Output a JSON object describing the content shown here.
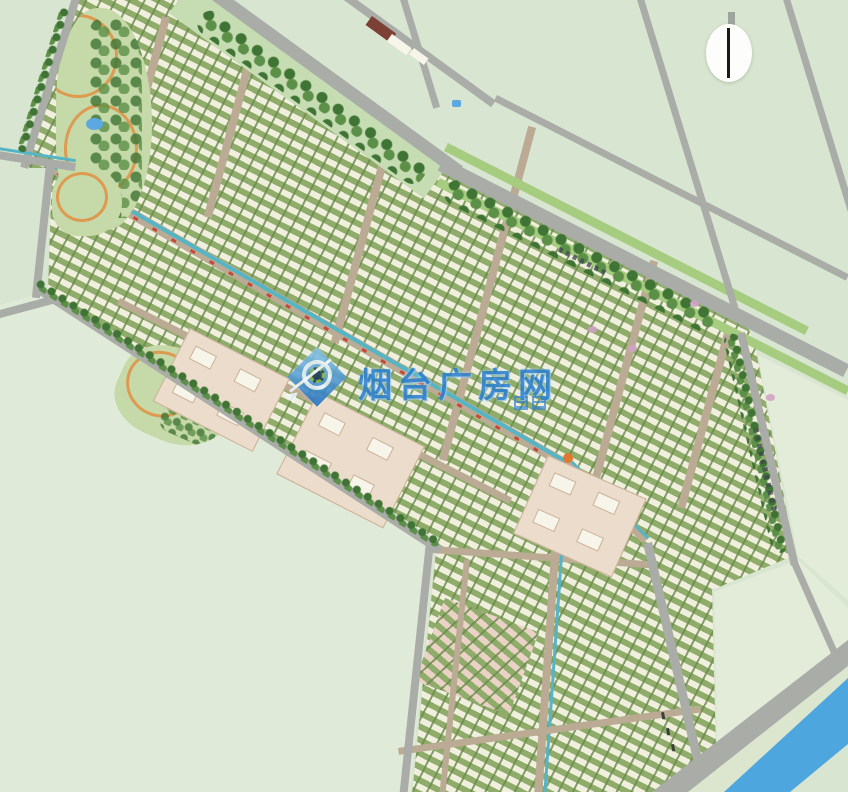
{
  "title": "residential district master plan (bird's-eye site plan)",
  "watermark": {
    "text": "烟台广房网",
    "logo": "diamond-lens-logo",
    "color": "#2e80d0"
  },
  "compass": {
    "icon": "north-arrow-compass"
  },
  "road_labels": {
    "note": "tiny illegible road-name characters along main road and east road"
  },
  "regions": [
    "residential-blocks-band",
    "lower-residential-wing",
    "main-arterial-road-with-green-verges",
    "tree-belt",
    "landscape-canal-axis",
    "public-building-clusters",
    "corner-parks-with-ponds",
    "open-field-parcels",
    "river-southeast-corner"
  ],
  "colors": {
    "background": "#d8e5d1",
    "field_sw": "#e0ead9",
    "field_se": "#e3ecd9",
    "road_major": "#a9aca7",
    "road_minor": "#bcab94",
    "verge": "#c6dcb2",
    "verge_bright": "#a6cc80",
    "tree_dark": "#3f7434",
    "tree_mid": "#5c9048",
    "block_green": "#8fac6b",
    "building_cream": "#f0eedd",
    "public_beige": "#ecdccb",
    "public_pink": "#ead2c6",
    "court_white": "#f7f4ea",
    "park_base": "#c6d9a8",
    "park_path": "#dd9a50",
    "pond_blue": "#5ca8e0",
    "canal_teal": "#55b5c5",
    "canal_red": "#c84838",
    "orange_node": "#e07830",
    "river_blue": "#4da6de",
    "embankment": "#dce6cf",
    "watermark_blue": "#2e80d0",
    "watermark_halo": "#bfe0f5",
    "compass_white": "#fdfdfb",
    "needle_black": "#191919",
    "label_dark": "#3f4450",
    "dark_red_roof": "#7c4034"
  }
}
